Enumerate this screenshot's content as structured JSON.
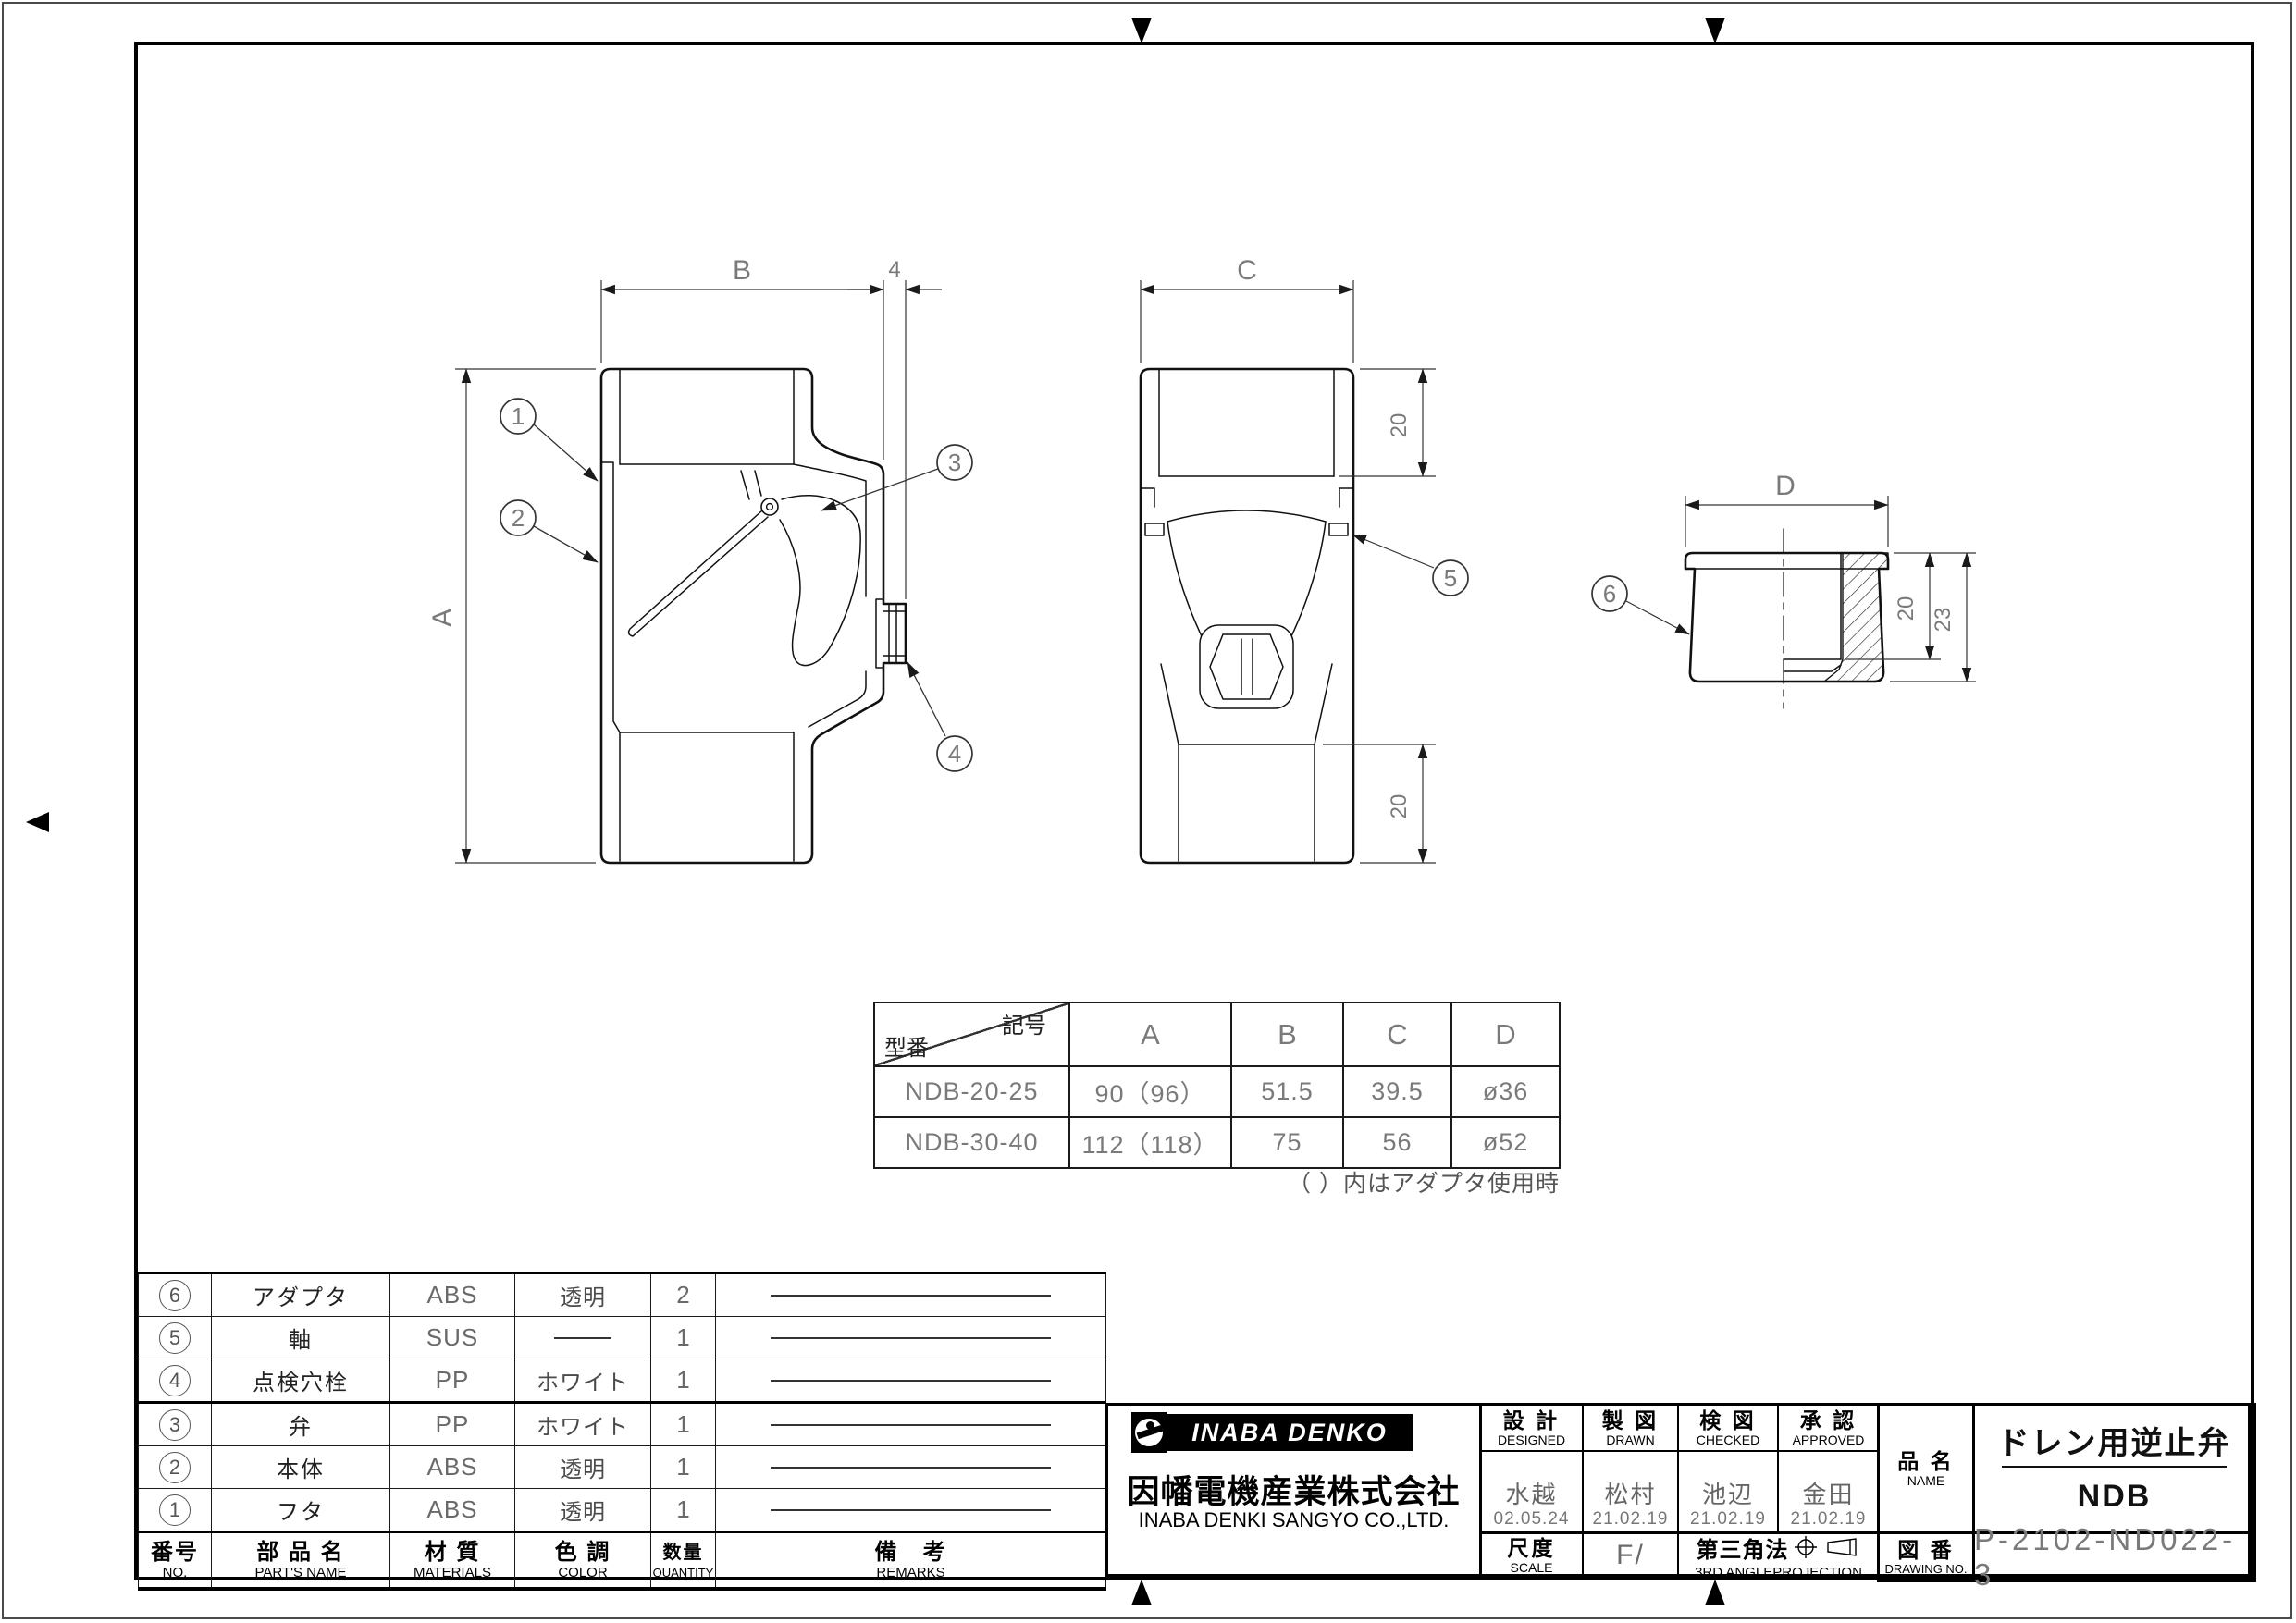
{
  "drawing": {
    "front": {
      "dim_a": "A",
      "dim_b": "B",
      "dim_gap": "4",
      "b1": "1",
      "b2": "2",
      "b3": "3",
      "b4": "4"
    },
    "side": {
      "dim_c": "C",
      "dim_top20": "20",
      "dim_bottom20": "20",
      "b5": "5"
    },
    "adapter": {
      "dim_d": "D",
      "dim_20": "20",
      "dim_23": "23",
      "b6": "6"
    },
    "note": "（ ）内はアダプタ使用時"
  },
  "dim_table": {
    "corner_top": "記号",
    "corner_bottom": "型番",
    "cols": [
      "A",
      "B",
      "C",
      "D"
    ],
    "rows": [
      {
        "model": "NDB-20-25",
        "a": "90（96）",
        "b": "51.5",
        "c": "39.5",
        "d": "ø36"
      },
      {
        "model": "NDB-30-40",
        "a": "112（118）",
        "b": "75",
        "c": "56",
        "d": "ø52"
      }
    ]
  },
  "parts_table": {
    "h": {
      "no_jp": "番号",
      "no_en": "NO.",
      "name_jp": "部 品 名",
      "name_en": "PART'S NAME",
      "mat_jp": "材 質",
      "mat_en": "MATERIALS",
      "col_jp": "色 調",
      "col_en": "COLOR",
      "qty_jp": "数量",
      "qty_en": "QUANTITY",
      "rem_jp": "備　考",
      "rem_en": "REMARKS"
    },
    "rows": [
      {
        "no": "6",
        "name": "アダプタ",
        "mat": "ABS",
        "color": "透明",
        "qty": "2"
      },
      {
        "no": "5",
        "name": "軸",
        "mat": "SUS",
        "color": "",
        "qty": "1"
      },
      {
        "no": "4",
        "name": "点検穴栓",
        "mat": "PP",
        "color": "ホワイト",
        "qty": "1"
      },
      {
        "no": "3",
        "name": "弁",
        "mat": "PP",
        "color": "ホワイト",
        "qty": "1"
      },
      {
        "no": "2",
        "name": "本体",
        "mat": "ABS",
        "color": "透明",
        "qty": "1"
      },
      {
        "no": "1",
        "name": "フタ",
        "mat": "ABS",
        "color": "透明",
        "qty": "1"
      }
    ]
  },
  "title_block": {
    "brand": "INABA DENKO",
    "company_jp": "因幡電機産業株式会社",
    "company_en": "INABA DENKI SANGYO CO.,LTD.",
    "cols": [
      {
        "jp": "設 計",
        "en": "DESIGNED",
        "name": "水越",
        "date": "02.05.24"
      },
      {
        "jp": "製 図",
        "en": "DRAWN",
        "name": "松村",
        "date": "21.02.19"
      },
      {
        "jp": "検 図",
        "en": "CHECKED",
        "name": "池辺",
        "date": "21.02.19"
      },
      {
        "jp": "承 認",
        "en": "APPROVED",
        "name": "金田",
        "date": "21.02.19"
      }
    ],
    "scale_jp": "尺度",
    "scale_en": "SCALE",
    "scale_value": "F/",
    "proj_jp": "第三角法",
    "proj_en": "3RD ANGLEPROJECTION",
    "name_jp": "品 名",
    "name_en": "NAME",
    "product_name": "ドレン用逆止弁",
    "product_model": "NDB",
    "no_jp": "図 番",
    "no_en": "DRAWING NO.",
    "drawing_no": "P-2102-ND022-3"
  }
}
